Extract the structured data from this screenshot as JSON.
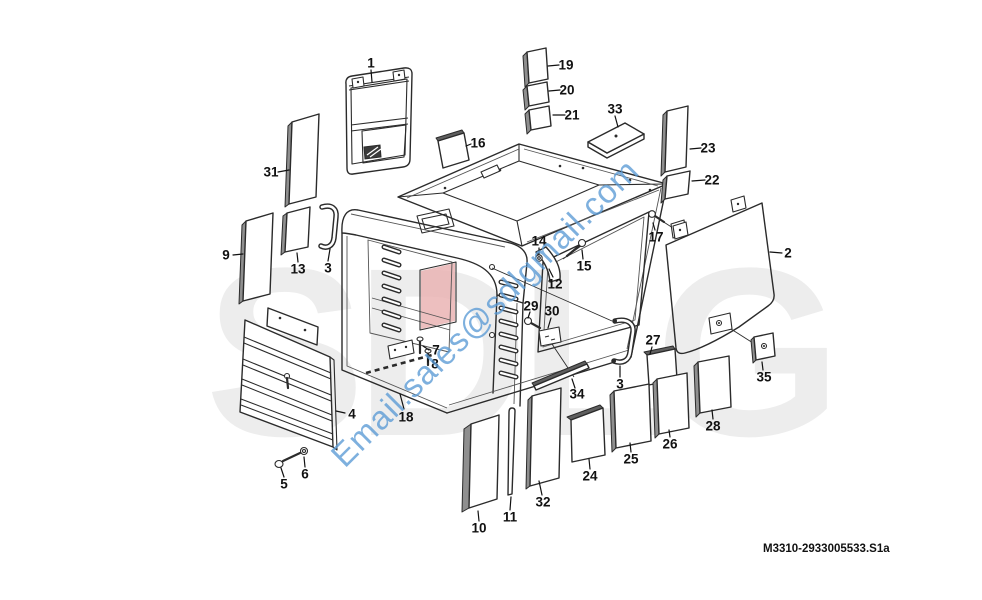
{
  "document": {
    "type": "cab exploded parts diagram",
    "figure_code": "M3310-2933005533.S1a"
  },
  "watermark": {
    "text": "Email.sales@sdlgmail.com",
    "color": "#5b9bd5",
    "rotation_deg": -45
  },
  "background_logo": {
    "text": "SDLG",
    "color": "#ededed",
    "accent_color": "#e9afaf"
  },
  "parts": [
    {
      "number": "1",
      "x": 371,
      "y": 63,
      "leader": [
        371,
        70,
        372,
        82
      ]
    },
    {
      "number": "31",
      "x": 271,
      "y": 172,
      "leader": [
        278,
        172,
        289,
        170
      ]
    },
    {
      "number": "9",
      "x": 226,
      "y": 255,
      "leader": [
        233,
        255,
        243,
        254
      ]
    },
    {
      "number": "13",
      "x": 298,
      "y": 269,
      "leader": [
        298,
        262,
        297,
        253
      ]
    },
    {
      "number": "3",
      "x": 328,
      "y": 268,
      "leader": [
        328,
        261,
        330,
        249
      ]
    },
    {
      "number": "4",
      "x": 352,
      "y": 414,
      "leader": [
        345,
        413,
        336,
        411
      ]
    },
    {
      "number": "5",
      "x": 284,
      "y": 484,
      "leader": [
        284,
        477,
        281,
        468
      ]
    },
    {
      "number": "6",
      "x": 305,
      "y": 474,
      "leader": [
        305,
        467,
        304,
        457
      ]
    },
    {
      "number": "18",
      "x": 406,
      "y": 417,
      "leader": [
        404,
        409,
        400,
        394
      ]
    },
    {
      "number": "7",
      "x": 436,
      "y": 350,
      "leader": [
        429,
        350,
        423,
        346
      ]
    },
    {
      "number": "8",
      "x": 435,
      "y": 364,
      "leader": [
        428,
        362,
        428,
        356
      ]
    },
    {
      "number": "10",
      "x": 479,
      "y": 528,
      "leader": [
        479,
        521,
        478,
        511
      ]
    },
    {
      "number": "11",
      "x": 510,
      "y": 517,
      "leader": [
        510,
        510,
        511,
        497
      ]
    },
    {
      "number": "32",
      "x": 543,
      "y": 502,
      "leader": [
        542,
        495,
        539,
        481
      ]
    },
    {
      "number": "34",
      "x": 577,
      "y": 394,
      "leader": [
        575,
        388,
        572,
        379
      ]
    },
    {
      "number": "24",
      "x": 590,
      "y": 476,
      "leader": [
        590,
        469,
        589,
        459
      ]
    },
    {
      "number": "25",
      "x": 631,
      "y": 459,
      "leader": [
        631,
        452,
        630,
        443
      ]
    },
    {
      "number": "26",
      "x": 670,
      "y": 444,
      "leader": [
        670,
        437,
        669,
        430
      ]
    },
    {
      "number": "28",
      "x": 713,
      "y": 426,
      "leader": [
        713,
        419,
        712,
        410
      ]
    },
    {
      "number": "27",
      "x": 653,
      "y": 340,
      "leader": [
        652,
        347,
        650,
        354
      ]
    },
    {
      "number": "35",
      "x": 764,
      "y": 377,
      "leader": [
        763,
        370,
        762,
        362
      ]
    },
    {
      "number": "2",
      "x": 788,
      "y": 253,
      "leader": [
        782,
        253,
        770,
        252
      ]
    },
    {
      "number": "17",
      "x": 656,
      "y": 237,
      "leader": [
        655,
        230,
        653,
        223
      ]
    },
    {
      "number": "22",
      "x": 712,
      "y": 180,
      "leader": [
        705,
        180,
        692,
        181
      ]
    },
    {
      "number": "23",
      "x": 708,
      "y": 148,
      "leader": [
        701,
        148,
        690,
        149
      ]
    },
    {
      "number": "33",
      "x": 615,
      "y": 109,
      "leader": [
        615,
        116,
        618,
        127
      ]
    },
    {
      "number": "19",
      "x": 566,
      "y": 65,
      "leader": [
        559,
        65,
        548,
        66
      ]
    },
    {
      "number": "20",
      "x": 567,
      "y": 90,
      "leader": [
        560,
        90,
        549,
        91
      ]
    },
    {
      "number": "21",
      "x": 572,
      "y": 115,
      "leader": [
        565,
        115,
        553,
        115
      ]
    },
    {
      "number": "16",
      "x": 478,
      "y": 143,
      "leader": [
        471,
        144,
        466,
        146
      ]
    },
    {
      "number": "14",
      "x": 539,
      "y": 241,
      "leader": [
        539,
        248,
        539,
        254
      ]
    },
    {
      "number": "15",
      "x": 584,
      "y": 266,
      "leader": [
        583,
        259,
        582,
        250
      ]
    },
    {
      "number": "12",
      "x": 555,
      "y": 284,
      "leader": [
        553,
        277,
        549,
        269
      ]
    },
    {
      "number": "29",
      "x": 531,
      "y": 306,
      "leader": [
        530,
        312,
        528,
        318
      ]
    },
    {
      "number": "30",
      "x": 552,
      "y": 311,
      "leader": [
        551,
        318,
        548,
        328
      ]
    },
    {
      "number": "3",
      "x": 620,
      "y": 384,
      "leader": [
        620,
        377,
        620,
        366
      ]
    }
  ]
}
